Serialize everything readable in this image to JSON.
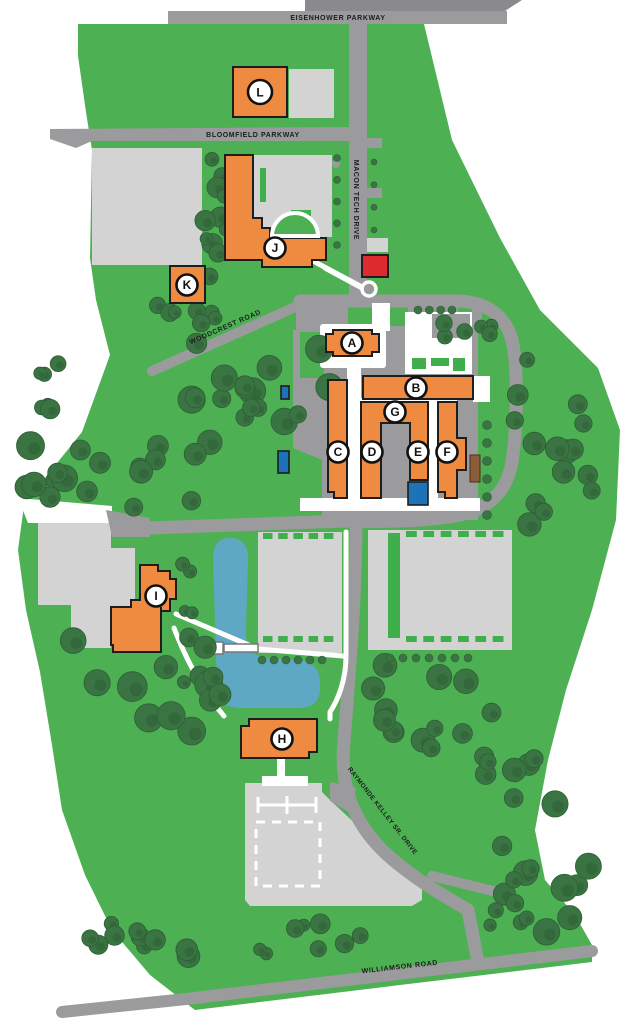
{
  "map_title": "Campus map",
  "roads": {
    "eisenhower": "EISENHOWER PARKWAY",
    "bloomfield": "BLOOMFIELD PARKWAY",
    "macon": "MACON TECH DRIVE",
    "woodcrest": "WOODCREST ROAD",
    "raymonde": "RAYMONDE KELLEY SR. DRIVE",
    "williamson": "WILLIAMSON ROAD"
  },
  "buildings": [
    {
      "label": "A"
    },
    {
      "label": "B"
    },
    {
      "label": "C"
    },
    {
      "label": "D"
    },
    {
      "label": "E"
    },
    {
      "label": "F"
    },
    {
      "label": "G"
    },
    {
      "label": "H"
    },
    {
      "label": "I"
    },
    {
      "label": "J"
    },
    {
      "label": "K"
    },
    {
      "label": "L"
    }
  ],
  "colors": {
    "campus_green": "#4DB153",
    "dash_green": "#3FAF4C",
    "tree_green": "#3A7442",
    "tree_edge": "#2E5E36",
    "road_gray": "#9B9B9D",
    "road_dark": "#8A8A8C",
    "parking_gray": "#D3D3D3",
    "building_orange": "#EF8B40",
    "pond_blue": "#5FA8C4",
    "accent_blue": "#1D72B8",
    "alert_red": "#DD2C30",
    "utility_brown": "#8A5D3B"
  }
}
